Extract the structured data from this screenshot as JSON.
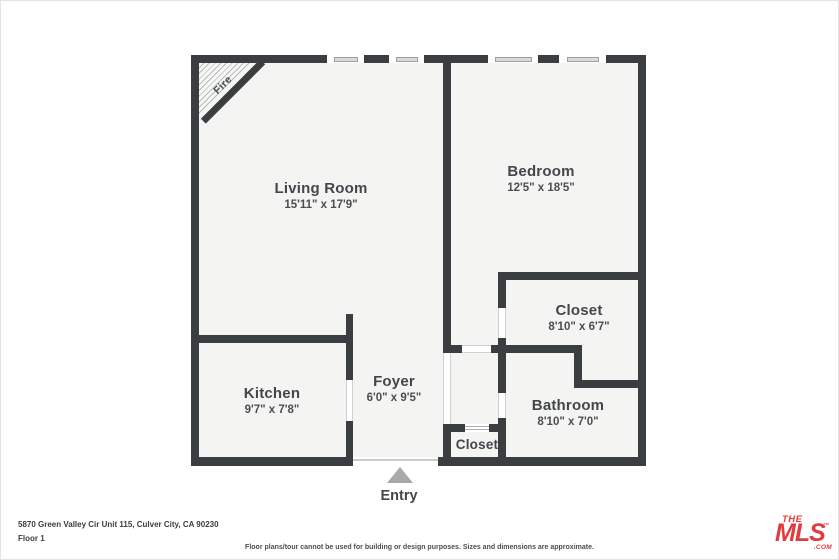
{
  "plan": {
    "fireplace_label": "Fire",
    "entry_label": "Entry",
    "rooms": [
      {
        "name": "Living Room",
        "dims": "15'11\" x 17'9\""
      },
      {
        "name": "Bedroom",
        "dims": "12'5\" x 18'5\""
      },
      {
        "name": "Closet",
        "dims": "8'10\" x 6'7\""
      },
      {
        "name": "Bathroom",
        "dims": "8'10\" x 7'0\""
      },
      {
        "name": "Kitchen",
        "dims": "9'7\" x 7'8\""
      },
      {
        "name": "Foyer",
        "dims": "6'0\" x 9'5\""
      },
      {
        "name": "Closet",
        "dims": ""
      }
    ]
  },
  "footer": {
    "address": "5870 Green Valley Cir Unit 115, Culver City, CA 90230",
    "floor": "Floor 1",
    "disclaimer": "Floor plans/tour cannot be used for building or design purposes. Sizes and dimensions are approximate."
  },
  "logo": {
    "the": "THE",
    "mls": "MLS",
    "tm": "™",
    "com": ".COM"
  },
  "colors": {
    "wall": "#3b3e41",
    "floor": "#f4f4f2",
    "window-glass": "#d9dadb",
    "arrow": "#a9a9a9",
    "logo-red": "#e23a3e",
    "text": "#43474b",
    "jamb": "#cfd1d2"
  }
}
